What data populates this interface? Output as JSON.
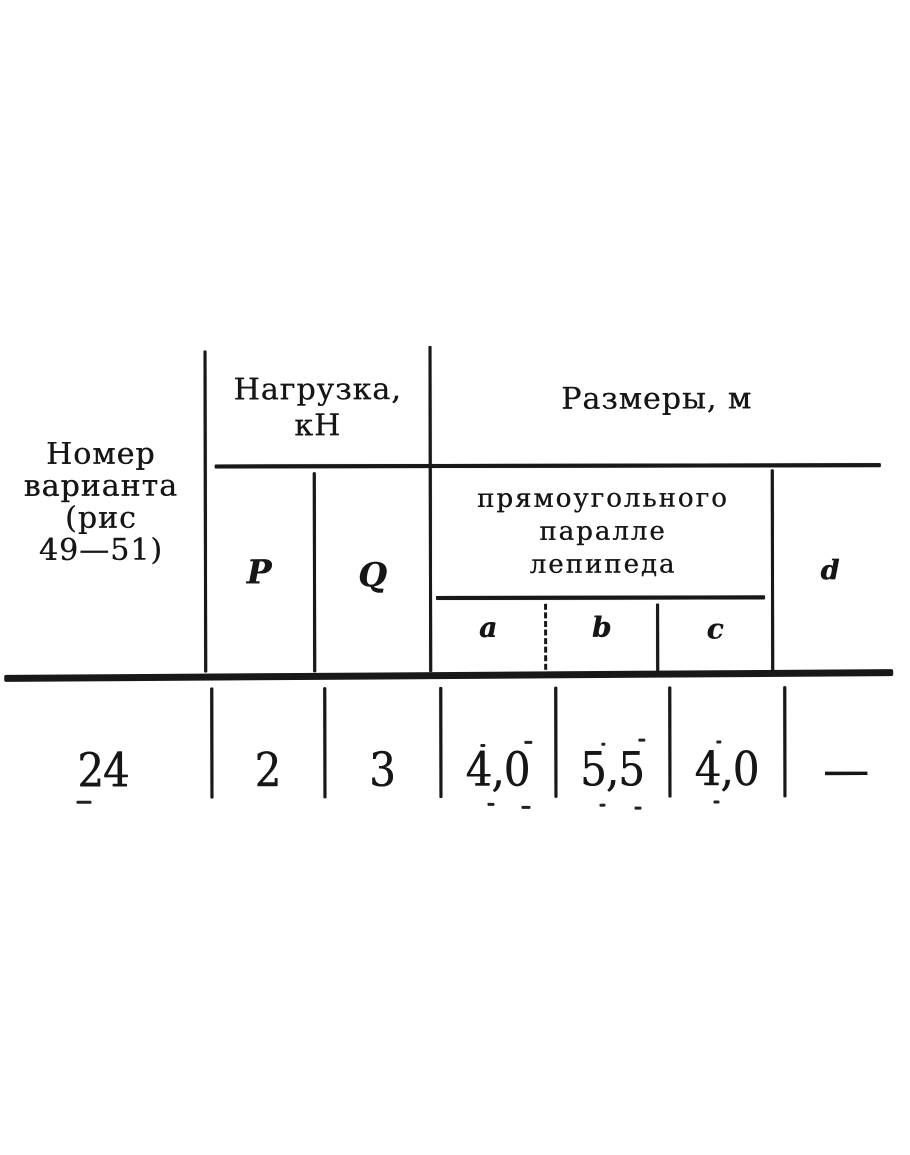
{
  "doc": {
    "kind": "scanned-table",
    "ink_color": "#181818",
    "paper_color": "#ffffff"
  },
  "header": {
    "variant_lines": [
      "Номер",
      "варианта",
      "(рис",
      "49—51)"
    ],
    "load_line1": "Нагрузка,",
    "load_line2": "кН",
    "dims": "Размеры, м",
    "ppd_lines": [
      "прямоугольного",
      "паралле",
      "лепипеда"
    ]
  },
  "columns": {
    "p": "P",
    "q": "Q",
    "a": "a",
    "b": "b",
    "c": "c",
    "d": "d"
  },
  "row": {
    "variant": "24",
    "p": "2",
    "q": "3",
    "a": "4,0",
    "b": "5,5",
    "c": "4,0",
    "d": "—"
  }
}
